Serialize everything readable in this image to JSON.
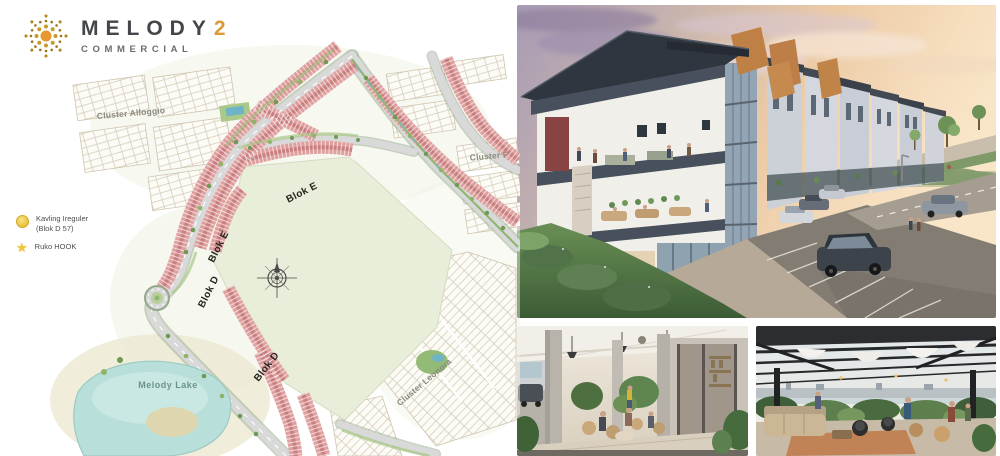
{
  "brand": {
    "name": "MELODY",
    "number": "2",
    "subtitle": "COMMERCIAL"
  },
  "legend": {
    "items": [
      {
        "icon": "kavling-irregular-circle",
        "line1": "Kavling Ireguler",
        "line2": "(Blok D 57)"
      },
      {
        "icon": "ruko-hook-star",
        "line1": "Ruko HOOK"
      }
    ]
  },
  "map": {
    "labels": {
      "cluster_alloggio": "Cluster Alloggio",
      "cluster_f": "Cluster F",
      "blok_e": "Blok E",
      "blok_d": "Blok D",
      "melody_lake": "Melody Lake",
      "cluster_leonora": "Cluster Leonora"
    }
  },
  "colors": {
    "brand_gold": "#C9A227",
    "brand_orange": "#DD9A3A",
    "brand_text": "#43464A",
    "map_pink": "#DF9F9F",
    "map_field": "#E9EEDA",
    "map_lake": "#BFE2DE",
    "legend_yellow": "#EEC83E"
  }
}
